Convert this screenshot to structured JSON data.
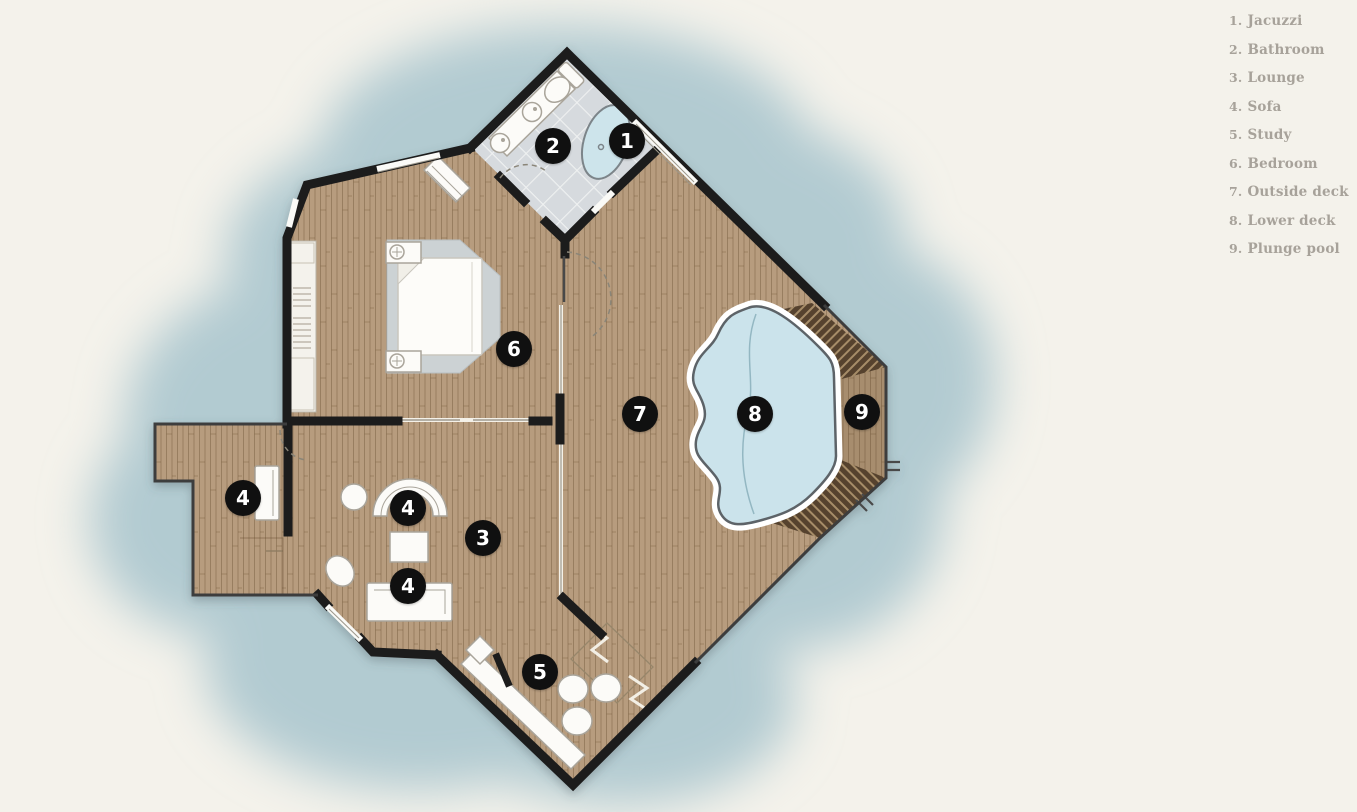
{
  "title": "Villa floor plan",
  "legend": {
    "items": [
      {
        "number": "1.",
        "label": "Jacuzzi"
      },
      {
        "number": "2.",
        "label": "Bathroom"
      },
      {
        "number": "3.",
        "label": "Lounge"
      },
      {
        "number": "4.",
        "label": "Sofa"
      },
      {
        "number": "5.",
        "label": "Study"
      },
      {
        "number": "6.",
        "label": "Bedroom"
      },
      {
        "number": "7.",
        "label": "Outside deck"
      },
      {
        "number": "8.",
        "label": "Lower deck"
      },
      {
        "number": "9.",
        "label": "Plunge pool"
      }
    ]
  },
  "markers": [
    {
      "number": "1",
      "room": "Jacuzzi"
    },
    {
      "number": "2",
      "room": "Bathroom"
    },
    {
      "number": "3",
      "room": "Lounge"
    },
    {
      "number": "4",
      "room": "Sofa"
    },
    {
      "number": "4",
      "room": "Sofa"
    },
    {
      "number": "4",
      "room": "Sofa"
    },
    {
      "number": "5",
      "room": "Study"
    },
    {
      "number": "6",
      "room": "Bedroom"
    },
    {
      "number": "7",
      "room": "Outside deck"
    },
    {
      "number": "8",
      "room": "Lower deck"
    },
    {
      "number": "9",
      "room": "Plunge pool"
    }
  ],
  "colors": {
    "background": "#f4f2eb",
    "water": "#b2cbd1",
    "wood": "#b79c7e",
    "wall": "#1e1e1e",
    "bathroom_tile": "#d6dade",
    "pool_water": "#cbe3eb",
    "pool_rim": "#ffffff",
    "bed_platform": "#ccd2d4",
    "furniture": "#fcfbf8",
    "stair_dark": "#56432f",
    "marker_background": "#101010",
    "marker_text": "#ffffff",
    "legend_text": "#a7a29a"
  }
}
